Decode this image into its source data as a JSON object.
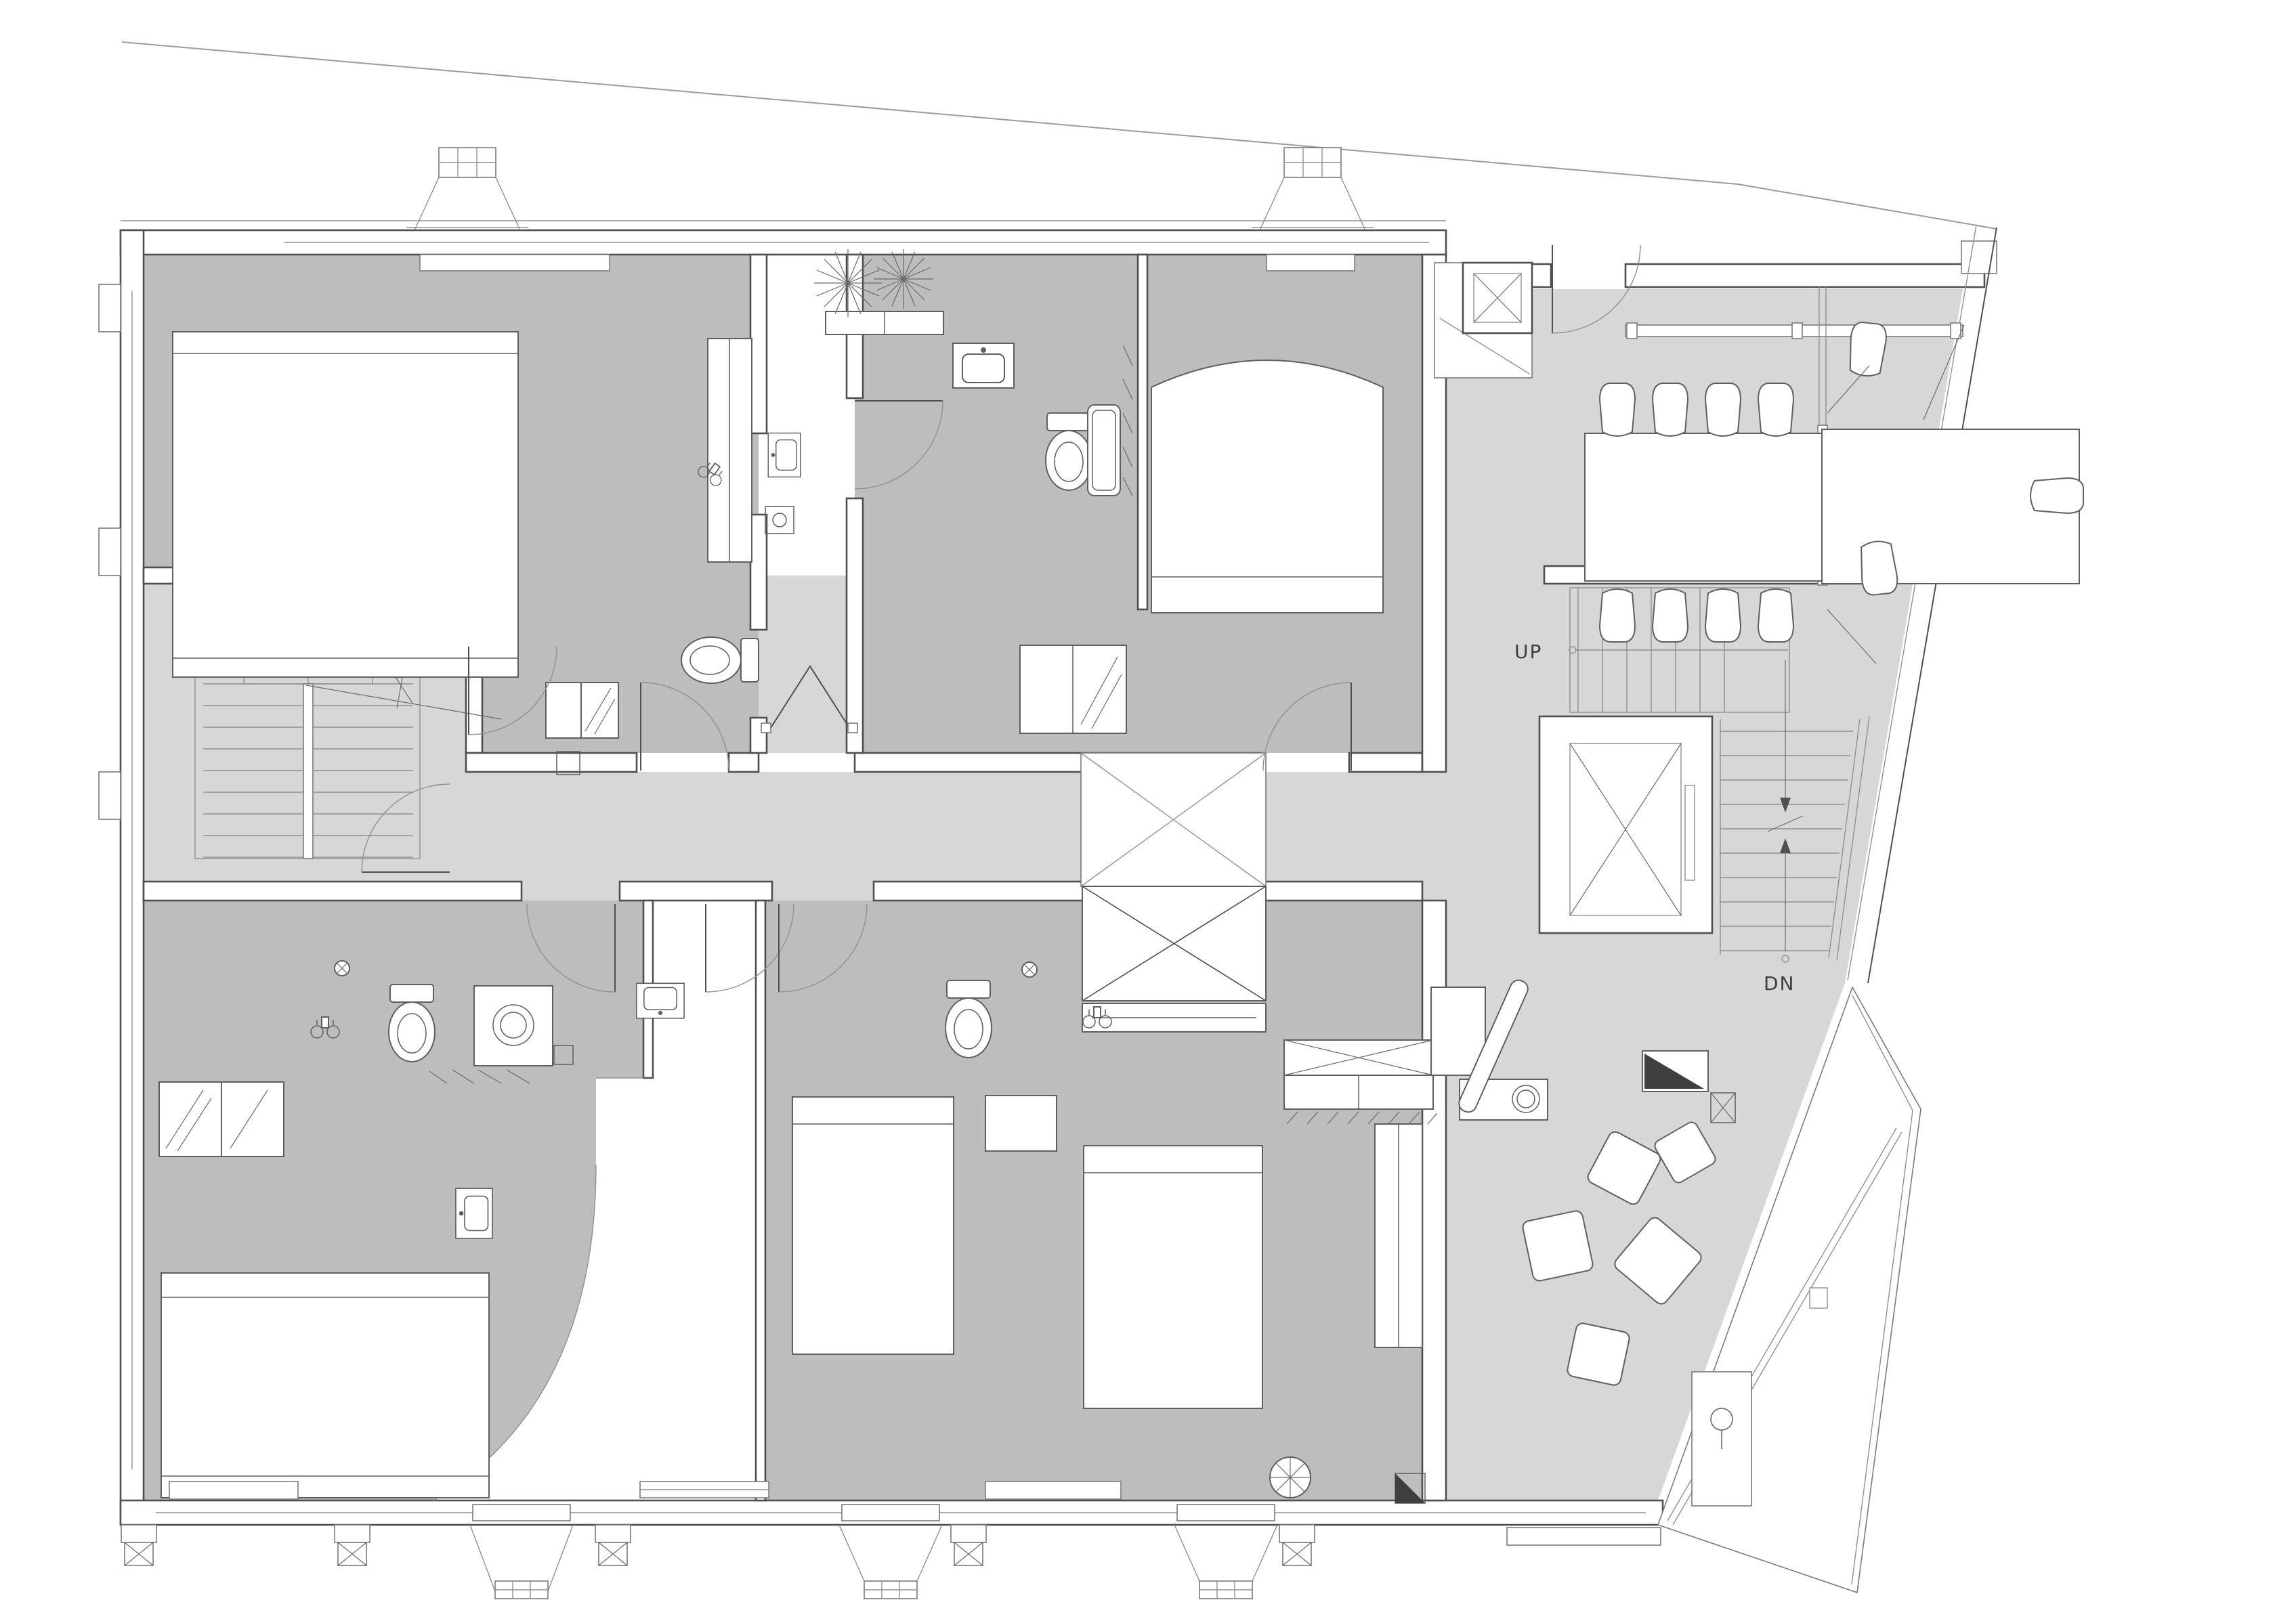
{
  "drawing": {
    "kind": "architectural floor plan",
    "style": "monochrome CAD line drawing, plan view"
  },
  "labels": {
    "stair_up": "UP",
    "stair_down": "DN"
  },
  "palette": {
    "background": "#ffffff",
    "floor_common": "#d7d7d7",
    "floor_room": "#bdbdbd",
    "wall_fill": "#ffffff",
    "wall_line": "#4f4f4f",
    "thin_line": "#909090",
    "fixture_line": "#5f5f5f",
    "label_color": "#3e3e3e",
    "accent_dark": "#3f3f3f"
  },
  "features": {
    "bedroom_suites": 4,
    "beds": 5,
    "toilets": 4,
    "sinks": 5,
    "bathtubs": 1,
    "stairs": 2,
    "elevators": 2,
    "conference_chairs": 11,
    "lounge_poufs": 5,
    "planter_plants": 2,
    "skylight_void_boxes": 2,
    "bay_windows": 5
  }
}
